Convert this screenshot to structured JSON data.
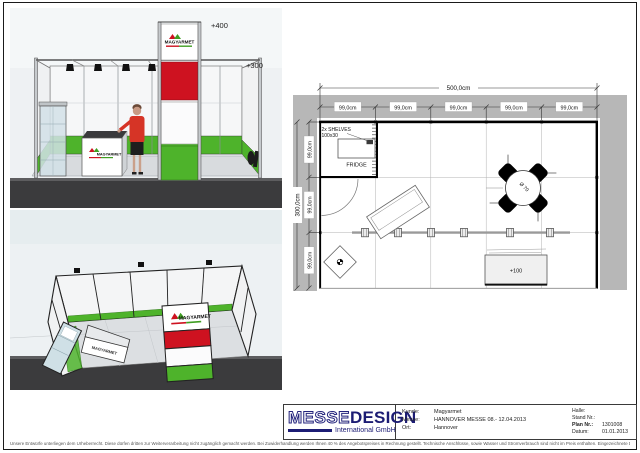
{
  "renderings": {
    "front": {
      "brand": "MAGYARMET",
      "counter_brand": "MAGYARMET",
      "elevation_top": "+400",
      "elevation_right": "+300"
    },
    "top": {
      "brand": "MAGYARMET",
      "counter_brand": "MAGYARMET"
    }
  },
  "floor_plan": {
    "total_width_label": "500,0cm",
    "col_segments": [
      "99,0cm",
      "99,0cm",
      "99,0cm",
      "99,0cm",
      "99,0cm"
    ],
    "total_depth_label": "300,0cm",
    "row_segments": [
      "99,0cm",
      "99,0cm",
      "99,0cm"
    ],
    "shelves_label": "2x SHELVES",
    "shelves_size": "100x30",
    "fridge_label": "FRIDGE",
    "table_label": "Ø 70",
    "counter_label": "+100"
  },
  "title_block": {
    "logo": {
      "messe": "MESSE",
      "design": "DESIGN",
      "subtitle": "International GmbH"
    },
    "fields_left": [
      {
        "label": "Kunde:",
        "value": "Magyarmet"
      },
      {
        "label": "Messe:",
        "value": "HANNOVER MESSE  08.- 12.04.2013"
      },
      {
        "label": "Ort:",
        "value": "Hannover"
      }
    ],
    "fields_right": [
      {
        "label": "Halle:",
        "value": ""
      },
      {
        "label": "Stand Nr.:",
        "value": ""
      },
      {
        "label": "Plan Nr.:",
        "value": "1301008"
      },
      {
        "label": "Datum:",
        "value": "01.01.2013"
      }
    ]
  },
  "footer": {
    "disclaimer": "Unsere Entwürfe unterliegen dem Urheberrecht. Diese dürfen dritten zur Weiterverarbeitung nicht zugänglich gemacht werden. Bei Zuwiderhandlung werden Ihnen 40 % des Angebotspreises in Rechnung gestellt. Technische Anschlüsse, sowie Wasser und Stromverbrauch sind nicht im Preis enthalten. Eingezeichnete Dekorationen und Gegenstände die nicht in der Leistungsbeschreibung enthalten sind, gehören nicht zum Lieferumfang. Änderungen durch die Messe bleiben vorbehalten."
  }
}
